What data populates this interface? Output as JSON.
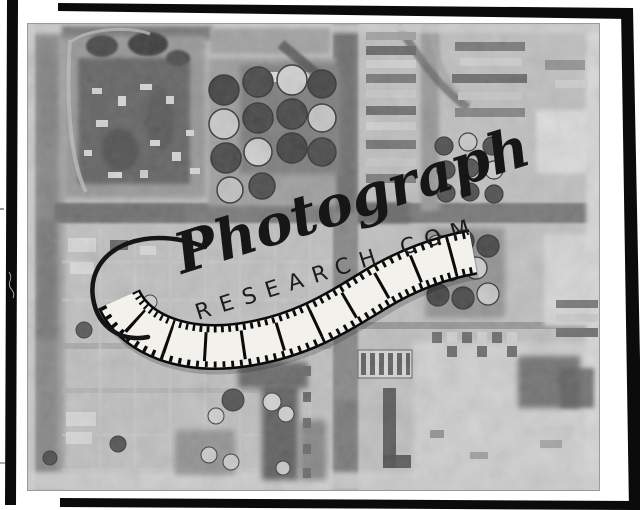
{
  "scan": {
    "paper_color": "#ffffff",
    "frame_color": "#0b0b0b",
    "photo_tone": "#bdbdbd",
    "description": "Black-and-white vertical aerial photograph of an industrial oil-refinery district: clusters of circular storage tanks, warehouse rows, a dark canal and a grid of roads, mounted in a black film-edge frame on white paper"
  },
  "watermark": {
    "script_text": "Photograph",
    "domain_text": "RESEARCH.COM",
    "ink_color": "#161616",
    "film_base_color": "#f2f1ec"
  }
}
